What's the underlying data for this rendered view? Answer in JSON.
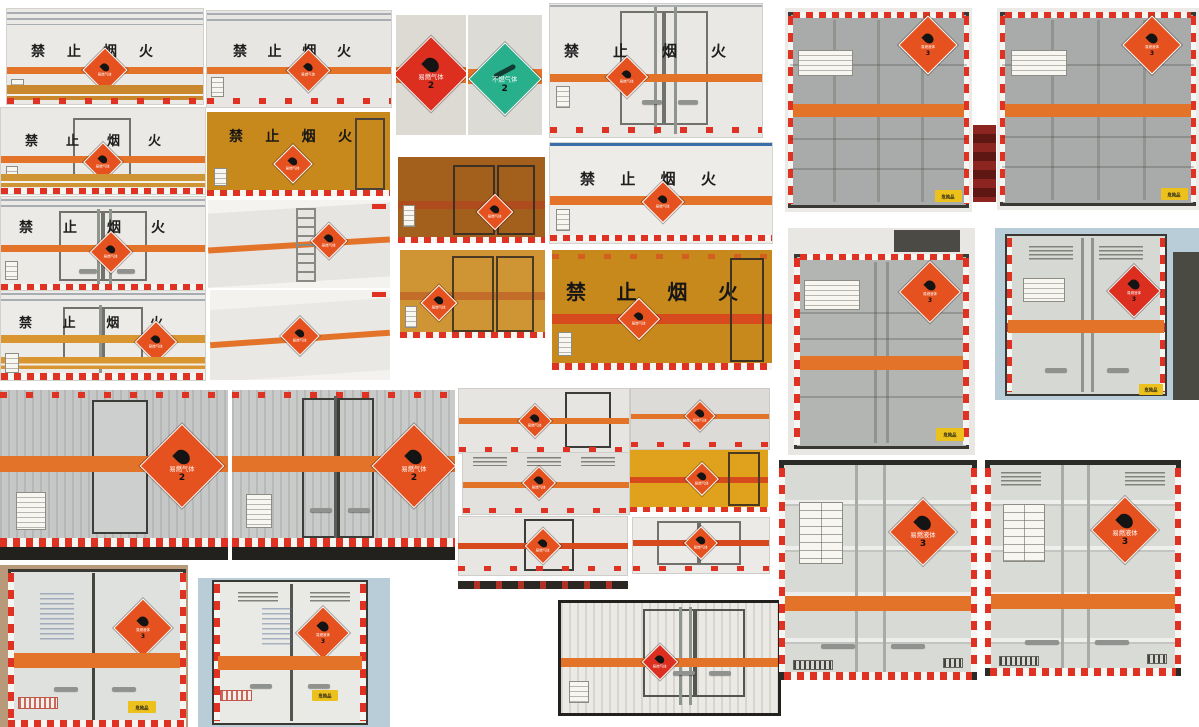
{
  "labels": {
    "no_fire": "禁止烟火"
  },
  "placards": {
    "flammable_gas": {
      "text": "易燃气体",
      "class_no": "2"
    },
    "non_flammable_gas": {
      "text": "不燃气体",
      "class_no": "2"
    },
    "flammable_liquid": {
      "text": "易燃液体",
      "class_no": "3"
    },
    "danger_plate": "危险品"
  },
  "colors": {
    "page_bg": "#ffffff",
    "stripe_orange": "#e4732a",
    "stripe_red": "#d64a1e",
    "band_tan": "#c9882e",
    "gold_box": "#c8891c",
    "amber_dark": "#a2601c",
    "amber_light": "#cf9434",
    "panel_white": "#eae9e5",
    "panel_gray": "#d7d8d4",
    "container_gray": "#a9abaa",
    "frame_dark": "#35332f",
    "reflect_red": "#df3222",
    "placard_orange": "#e6521f",
    "placard_red": "#dc2f1f",
    "placard_green": "#28b08c",
    "yellow_plate": "#edc11c",
    "sky_blue": "#b9cdd9"
  },
  "photos": [
    {
      "name": "box-side-1",
      "view": "side",
      "banner": "禁止烟火",
      "placard": "易燃气体 2"
    },
    {
      "name": "box-side-2",
      "view": "side",
      "banner": "禁止烟火",
      "placard": "易燃气体 2"
    },
    {
      "name": "placard-flammable-gas",
      "view": "placard",
      "placard": "易燃气体 2"
    },
    {
      "name": "placard-non-flammable-gas",
      "view": "placard",
      "placard": "不燃气体 2"
    },
    {
      "name": "box-rear-doors-1",
      "view": "rear",
      "banner": "禁止烟火",
      "placard": "易燃气体 2"
    },
    {
      "name": "container-rear-1",
      "view": "rear",
      "placard": "易燃液体 3",
      "plate": "危险品"
    },
    {
      "name": "container-rear-2",
      "view": "rear",
      "placard": "易燃液体 3",
      "plate": "危险品"
    },
    {
      "name": "box-side-with-door",
      "view": "side",
      "banner": "禁止烟火",
      "placard": "易燃气体 2"
    },
    {
      "name": "box-rear-gold",
      "view": "rear",
      "banner": "禁止烟火",
      "placard": "易燃气体 2"
    },
    {
      "name": "box-rear-amber-dark",
      "view": "rear",
      "placard": "易燃气体 2"
    },
    {
      "name": "box-side-3",
      "view": "side",
      "banner": "禁止烟火",
      "placard": "易燃气体 2"
    },
    {
      "name": "box-rear-doors-2",
      "view": "rear",
      "banner": "禁止烟火",
      "placard": "易燃气体 2"
    },
    {
      "name": "box-side-ladder",
      "view": "side",
      "placard": "易燃气体 2"
    },
    {
      "name": "box-rear-amber-light",
      "view": "rear",
      "placard": "易燃气体 2"
    },
    {
      "name": "box-side-gold-large",
      "view": "side",
      "banner": "禁止烟火",
      "placard": "易燃气体 2"
    },
    {
      "name": "box-rear-doors-3",
      "view": "rear",
      "banner": "禁止烟火",
      "placard": "易燃气体 2"
    },
    {
      "name": "box-side-perspective",
      "view": "side",
      "placard": "易燃气体 2"
    },
    {
      "name": "container-rear-3",
      "view": "rear",
      "placard": "易燃液体 3",
      "plate": "危险品"
    },
    {
      "name": "box-rear-vented",
      "view": "rear",
      "placard": "易燃液体 3",
      "plate": "危险品"
    },
    {
      "name": "van-side-large",
      "view": "side",
      "placard": "易燃气体 2"
    },
    {
      "name": "van-rear-large",
      "view": "rear",
      "placard": "易燃气体 2"
    },
    {
      "name": "small-side-door",
      "view": "side",
      "placard": "易燃气体 2"
    },
    {
      "name": "small-side-plain",
      "view": "side",
      "placard": "易燃气体 2"
    },
    {
      "name": "small-side-vented",
      "view": "side",
      "placard": "易燃气体 2"
    },
    {
      "name": "small-side-gold",
      "view": "side",
      "placard": "易燃气体 2"
    },
    {
      "name": "small-side-door-2",
      "view": "side",
      "placard": "易燃气体 2"
    },
    {
      "name": "small-rear-doors",
      "view": "rear",
      "placard": "易燃气体 2"
    },
    {
      "name": "truck-rear-bottom-left",
      "view": "rear",
      "placard": "易燃液体 3",
      "plate": "危险品"
    },
    {
      "name": "truck-rear-bottom-left-2",
      "view": "rear",
      "placard": "易燃液体 3",
      "plate": "危险品"
    },
    {
      "name": "truck-rear-wide",
      "view": "rear",
      "placard": "易燃气体 2"
    },
    {
      "name": "truck-rear-large-1",
      "view": "rear",
      "placard": "易燃液体 3"
    },
    {
      "name": "truck-rear-large-2",
      "view": "rear",
      "placard": "易燃液体 3"
    }
  ]
}
